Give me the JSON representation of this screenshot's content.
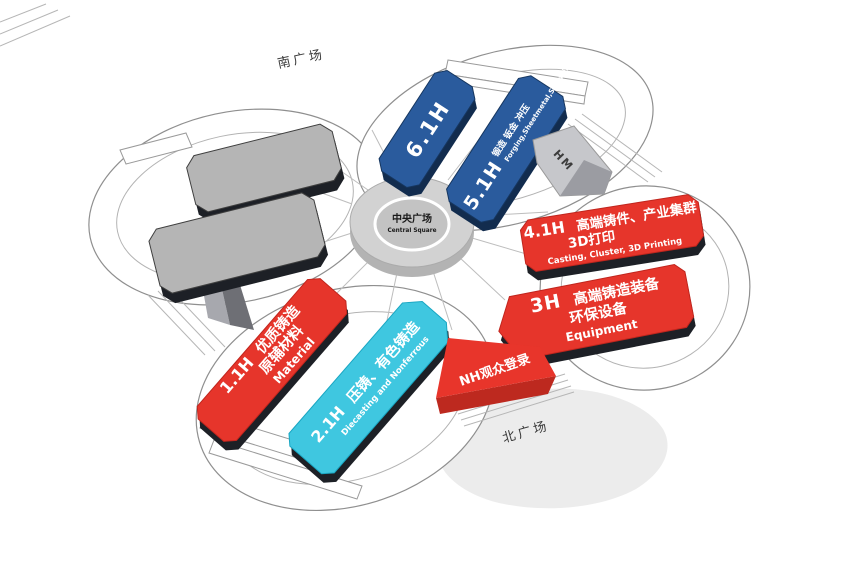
{
  "labels": {
    "south_square": "南广场",
    "north_square": "北广场",
    "central_square_zh": "中央广场",
    "central_square_en": "Central Square",
    "ramp": "HM",
    "nh_registration": "NH观众登录"
  },
  "halls": {
    "h61": {
      "id": "6.1H"
    },
    "h51": {
      "id": "5.1H",
      "zh": "锻造 钣金 冲压",
      "en": "Forging,Sheetmetal,Stamping"
    },
    "h41": {
      "id": "4.1H",
      "zh1": "高端铸件、产业集群",
      "zh2": "3D打印",
      "en": "Casting, Cluster, 3D Printing"
    },
    "h3": {
      "id": "3H",
      "zh1": "高端铸造装备",
      "zh2": "环保设备",
      "en": "Equipment"
    },
    "h11": {
      "id": "1.1H",
      "zh1": "优质铸造",
      "zh2": "原辅材料",
      "en": "Material"
    },
    "h21": {
      "id": "2.1H",
      "zh1": "压铸、有色铸造",
      "en": "Diecasting and Nonferrous"
    }
  },
  "colors": {
    "hall_red": "#e6352b",
    "red_stroke": "#c0251d",
    "hall_blue": "#2a5b9d",
    "blue_stroke": "#16365f",
    "blue_side": "#122c4e",
    "hall_cyan": "#3fc7e0",
    "cyan_stroke": "#19a6c2",
    "hall_gray": "#b5b5b5",
    "gray_stroke": "#4a4a4a",
    "slab_side": "#1d2026",
    "banner_red": "#e8352b",
    "banner_side": "#bd291f",
    "shadow": "#ececec",
    "ring_top": "#d2d2d2",
    "ring_inner": "#c3c3c3",
    "ring_under": "#b3b3b3"
  }
}
